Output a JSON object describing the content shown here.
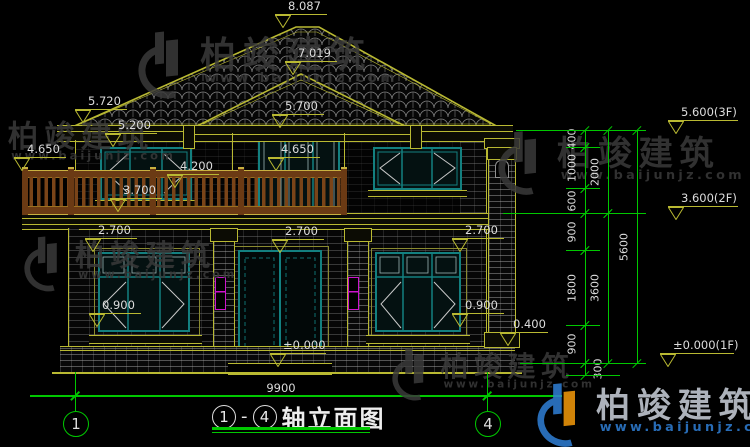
{
  "drawing_title": {
    "axis_start": "1",
    "separator": "-",
    "axis_end": "4",
    "name": "轴立面图"
  },
  "overall_dimension": "9900",
  "grid_bubbles": [
    {
      "label": "1",
      "x": 75
    },
    {
      "label": "4",
      "x": 487
    }
  ],
  "elevation_markers": [
    {
      "label": "8.087",
      "x": 283,
      "y": 28,
      "w": 52
    },
    {
      "label": "7.019",
      "x": 293,
      "y": 75,
      "w": 52
    },
    {
      "label": "5.720",
      "x": 83,
      "y": 123,
      "w": 52
    },
    {
      "label": "5.200",
      "x": 113,
      "y": 147,
      "w": 52
    },
    {
      "label": "5.700",
      "x": 280,
      "y": 128,
      "w": 52
    },
    {
      "label": "4.650",
      "x": 22,
      "y": 171,
      "w": 52
    },
    {
      "label": "4.650",
      "x": 276,
      "y": 171,
      "w": 52
    },
    {
      "label": "4.200",
      "x": 175,
      "y": 188,
      "w": 52
    },
    {
      "label": "3.700",
      "x": 118,
      "y": 212,
      "w": 52
    },
    {
      "label": "2.700",
      "x": 93,
      "y": 252,
      "w": 52
    },
    {
      "label": "2.700",
      "x": 280,
      "y": 253,
      "w": 52
    },
    {
      "label": "2.700",
      "x": 460,
      "y": 252,
      "w": 52
    },
    {
      "label": "0.900",
      "x": 97,
      "y": 327,
      "w": 52
    },
    {
      "label": "0.900",
      "x": 460,
      "y": 327,
      "w": 52
    },
    {
      "label": "0.400",
      "x": 508,
      "y": 346,
      "w": 48
    },
    {
      "label": "±0.000",
      "x": 278,
      "y": 367,
      "w": 56
    },
    {
      "label": "5.600(3F)",
      "x": 676,
      "y": 134,
      "w": 70
    },
    {
      "label": "3.600(2F)",
      "x": 676,
      "y": 220,
      "w": 70
    },
    {
      "label": "±0.000(1F)",
      "x": 668,
      "y": 367,
      "w": 74
    }
  ],
  "dimension_chains": [
    {
      "x": 585,
      "segments": [
        {
          "label": "400",
          "from": 130,
          "to": 147
        },
        {
          "label": "1000",
          "from": 147,
          "to": 188
        },
        {
          "label": "600",
          "from": 188,
          "to": 213
        },
        {
          "label": "900",
          "from": 213,
          "to": 250
        },
        {
          "label": "1800",
          "from": 250,
          "to": 325
        },
        {
          "label": "900",
          "from": 325,
          "to": 363
        },
        {
          "label": "300",
          "from": 363,
          "to": 375,
          "side": 1
        }
      ]
    },
    {
      "x": 608,
      "segments": [
        {
          "label": "2000",
          "from": 130,
          "to": 213
        },
        {
          "label": "3600",
          "from": 213,
          "to": 363
        }
      ]
    },
    {
      "x": 637,
      "segments": [
        {
          "label": "5600",
          "from": 130,
          "to": 363
        }
      ]
    }
  ],
  "level_lines": [
    {
      "y": 130,
      "x1": 516,
      "x2": 646
    },
    {
      "y": 213,
      "x1": 503,
      "x2": 646
    },
    {
      "y": 363,
      "x1": 520,
      "x2": 646
    },
    {
      "y": 147,
      "x1": 566,
      "x2": 600
    },
    {
      "y": 188,
      "x1": 566,
      "x2": 600
    },
    {
      "y": 250,
      "x1": 566,
      "x2": 600
    },
    {
      "y": 325,
      "x1": 566,
      "x2": 600
    },
    {
      "y": 375,
      "x1": 566,
      "x2": 620
    }
  ],
  "brand": {
    "name": "柏竣建筑",
    "website": "www.baijunjz.com"
  },
  "watermarks": [
    {
      "x": -45,
      "y": 112,
      "scale": 0.85,
      "style": "gray"
    },
    {
      "x": 138,
      "y": 26,
      "scale": 1.0,
      "style": "gray"
    },
    {
      "x": 24,
      "y": 232,
      "scale": 0.82,
      "style": "gray"
    },
    {
      "x": 498,
      "y": 126,
      "scale": 0.95,
      "style": "gray"
    },
    {
      "x": 392,
      "y": 344,
      "scale": 0.78,
      "style": "gray"
    },
    {
      "x": 537,
      "y": 378,
      "scale": 0.95,
      "style": "brand"
    }
  ],
  "colors": {
    "background": "#000000",
    "line_yellow": "#b9b932",
    "dim_green": "#00c800",
    "window_teal": "#138080",
    "railing_brown": "#7a4418",
    "lamp_magenta": "#cc14cc",
    "text_white": "#dcdcdc",
    "watermark_gray": "#3a3a3a",
    "brand_blue": "#2f7fd6",
    "brand_orange": "#f59a0a"
  }
}
